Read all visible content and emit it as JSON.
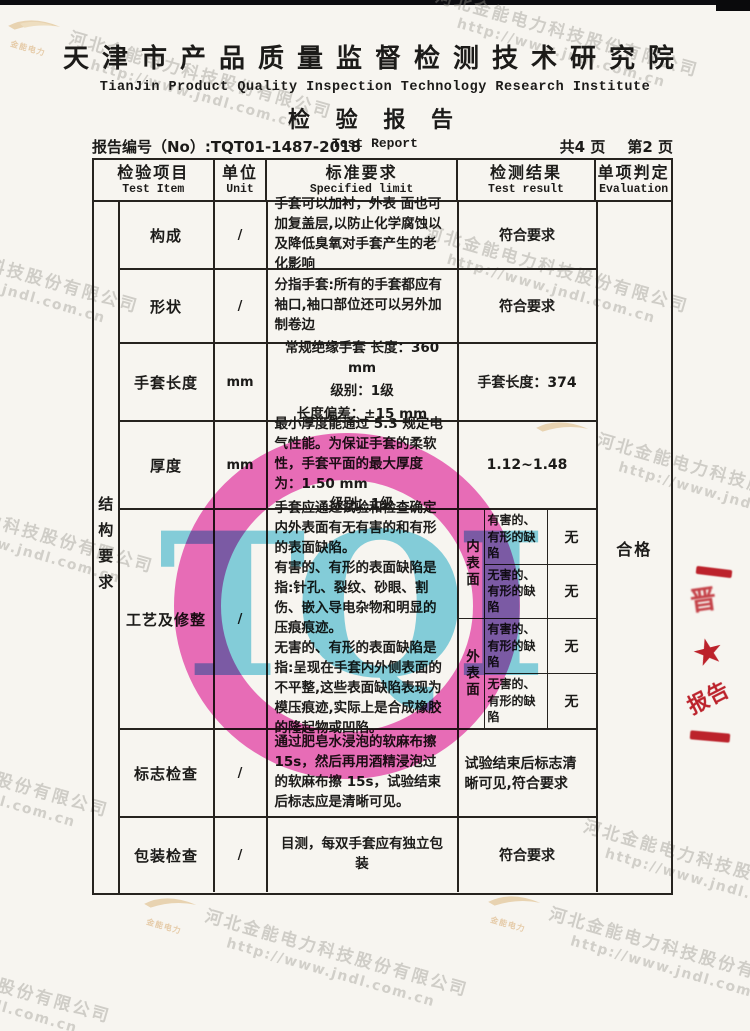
{
  "header": {
    "institute_cn": "天津市产品质量监督检测技术研究院",
    "institute_en": "TianJin Product Quality Inspection Technology Research Institute",
    "title_cn": "检 验 报 告",
    "title_en": "Test Report",
    "report_no_label": "报告编号（No）:",
    "report_no_value": "TQT01-1487-2018",
    "pages_total": "共4 页",
    "page_current": "第2 页"
  },
  "table": {
    "headers": {
      "item_cn": "检验项目",
      "item_en": "Test Item",
      "unit_cn": "单位",
      "unit_en": "Unit",
      "spec_cn": "标准要求",
      "spec_en": "Specified limit",
      "result_cn": "检测结果",
      "result_en": "Test result",
      "eval_cn": "单项判定",
      "eval_en": "Evaluation"
    },
    "side_label": "结构要求",
    "evaluation": "合格",
    "rows": [
      {
        "item": "构成",
        "unit": "/",
        "spec": "手套可以加衬，外表 面也可加复盖层,以防止化学腐蚀以及降低臭氧对手套产生的老化影响",
        "result": "符合要求"
      },
      {
        "item": "形状",
        "unit": "/",
        "spec": "分指手套:所有的手套都应有袖口,袖口部位还可以另外加制卷边",
        "result": "符合要求"
      },
      {
        "item": "手套长度",
        "unit": "mm",
        "spec_lines": [
          "常规绝缘手套 长度：360 mm",
          "级别：1级",
          "长度偏差：±15 mm"
        ],
        "result": "手套长度：374"
      },
      {
        "item": "厚度",
        "unit": "mm",
        "spec": "最小厚度能通过 5.3 规定电气性能。为保证手套的柔软性，手套平面的最大厚度为：1.50 mm",
        "spec_line2": "级别：1级",
        "result": "1.12~1.48"
      },
      {
        "item": "标志检查",
        "unit": "/",
        "spec": "通过肥皂水浸泡的软麻布擦15s，然后再用酒精浸泡过的软麻布擦 15s，试验结束后标志应是清晰可见。",
        "result": "试验结束后标志清晰可见,符合要求"
      },
      {
        "item": "包装检查",
        "unit": "/",
        "spec": "目测，每双手套应有独立包装",
        "result": "符合要求"
      }
    ],
    "craft": {
      "item": "工艺及修整",
      "unit": "/",
      "spec_p1": "手套应通过试验和检查确定内外表面有无有害的和有形的表面缺陷。",
      "spec_p2": "有害的、有形的表面缺陷是指:针孔、裂纹、砂眼、割伤、嵌入导电杂物和明显的压痕痕迹。",
      "spec_p3": "无害的、有形的表面缺陷是指:呈现在手套内外侧表面的不平整,这些表面缺陷表现为模压痕迹,实际上是合成橡胶的隆起物或凹陷。",
      "groups": [
        {
          "surface": "内表面",
          "items": [
            {
              "label": "有害的、有形的缺陷",
              "value": "无"
            },
            {
              "label": "无害的、有形的缺陷",
              "value": "无"
            }
          ]
        },
        {
          "surface": "外表面",
          "items": [
            {
              "label": "有害的、有形的缺陷",
              "value": "无"
            },
            {
              "label": "无害的、有形的缺陷",
              "value": "无"
            }
          ]
        }
      ]
    }
  },
  "stamp": {
    "letters": "TQI"
  },
  "seal": {
    "partial_glyph": "晋",
    "star": "★",
    "text": "报告"
  },
  "watermark": {
    "company": "河北金能电力科技股份有限公司",
    "url": "http://www.jndl.com.cn",
    "logo_text": "金能电力"
  }
}
